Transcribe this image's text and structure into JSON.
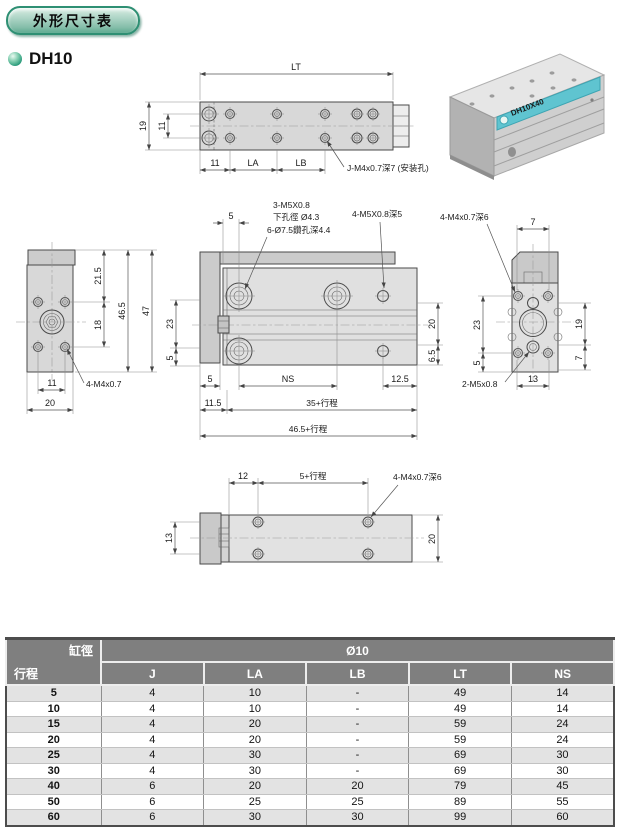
{
  "header": {
    "badge": "外形尺寸表",
    "model": "DH10"
  },
  "photo": {
    "label": "DH10X40"
  },
  "top_view": {
    "lt": "LT",
    "d19": "19",
    "d11side": "11",
    "d11": "11",
    "la": "LA",
    "lb": "LB",
    "callout": "J-M4x0.7深7 (安装孔)"
  },
  "left_view": {
    "d215": "21.5",
    "d18": "18",
    "d465": "46.5",
    "d47": "47",
    "d11": "11",
    "d20": "20",
    "callout": "4-M4x0.7"
  },
  "front_view": {
    "c1a": "3-M5X0.8",
    "c1b": "下孔徑 Ø4.3",
    "c1c": "6-Ø7.5鑽孔深4.4",
    "c2": "4-M5X0.8深5",
    "d5t": "5",
    "d23": "23",
    "d5l": "5",
    "ns": "NS",
    "d125": "12.5",
    "d115": "11.5",
    "d35": "35+行程",
    "d4655": "46.5+行程",
    "d20": "20",
    "d65": "6.5"
  },
  "right_view": {
    "callout_top": "4-M4x0.7深6",
    "d7t": "7",
    "d23": "23",
    "d5": "5",
    "d19": "19",
    "d7r": "7",
    "callout_bot": "2-M5x0.8",
    "d13": "13"
  },
  "bottom_view": {
    "d12": "12",
    "d5s": "5+行程",
    "callout": "4-M4x0.7深6",
    "d13": "13",
    "d20": "20"
  },
  "table": {
    "corner_top": "缸徑",
    "corner_bottom": "行程",
    "bore_header": "Ø10",
    "columns": [
      "J",
      "LA",
      "LB",
      "LT",
      "NS"
    ],
    "rows": [
      {
        "stroke": "5",
        "values": [
          "4",
          "10",
          "-",
          "49",
          "14"
        ]
      },
      {
        "stroke": "10",
        "values": [
          "4",
          "10",
          "-",
          "49",
          "14"
        ]
      },
      {
        "stroke": "15",
        "values": [
          "4",
          "20",
          "-",
          "59",
          "24"
        ]
      },
      {
        "stroke": "20",
        "values": [
          "4",
          "20",
          "-",
          "59",
          "24"
        ]
      },
      {
        "stroke": "25",
        "values": [
          "4",
          "30",
          "-",
          "69",
          "30"
        ]
      },
      {
        "stroke": "30",
        "values": [
          "4",
          "30",
          "-",
          "69",
          "30"
        ]
      },
      {
        "stroke": "40",
        "values": [
          "6",
          "20",
          "20",
          "79",
          "45"
        ]
      },
      {
        "stroke": "50",
        "values": [
          "6",
          "25",
          "25",
          "89",
          "55"
        ]
      },
      {
        "stroke": "60",
        "values": [
          "6",
          "30",
          "30",
          "99",
          "60"
        ]
      }
    ]
  }
}
